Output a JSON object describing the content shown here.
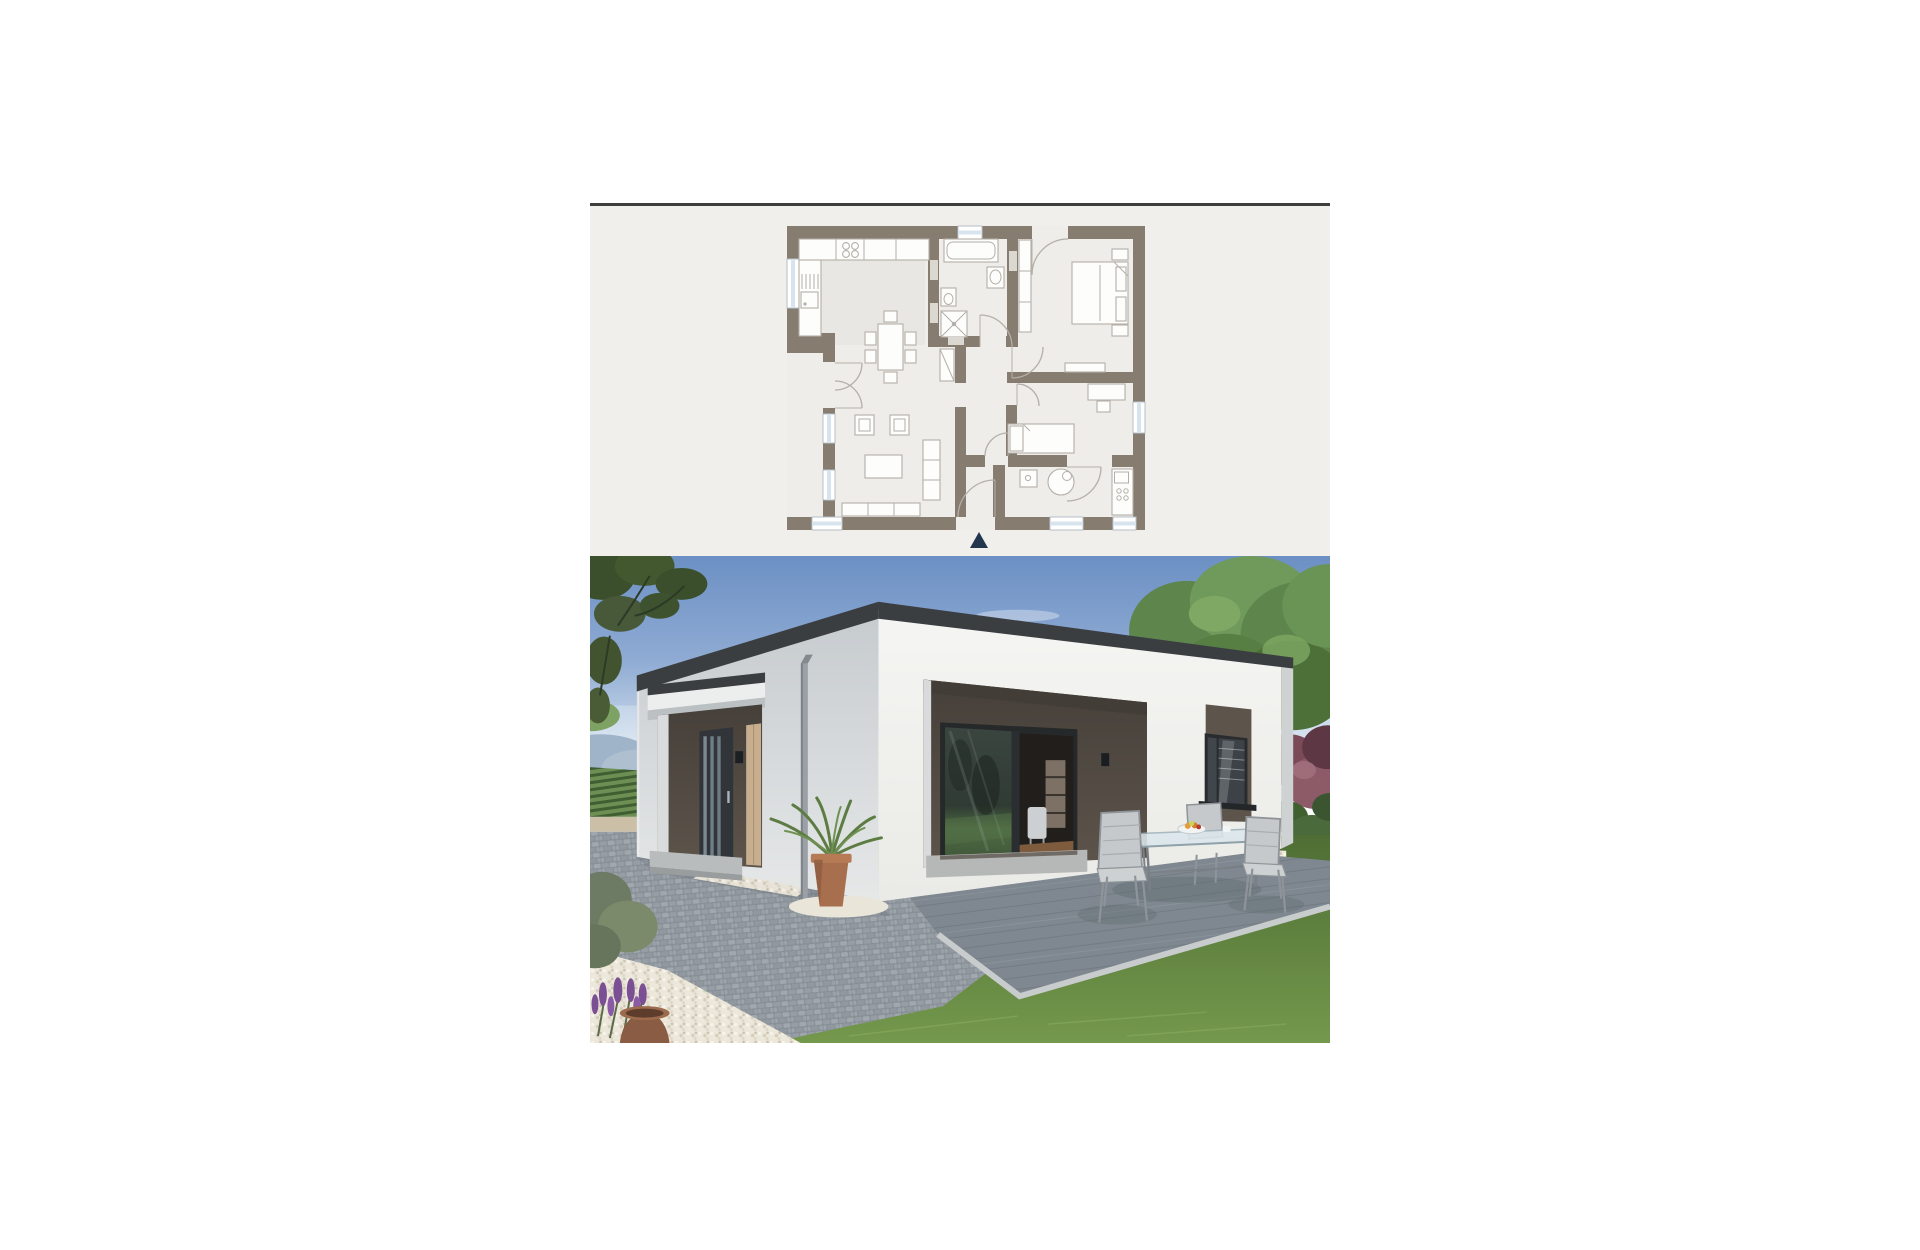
{
  "page": {
    "background": "#ffffff"
  },
  "listing": {
    "description_elements": [
      "floor-plan-panel",
      "exterior-render-photo"
    ],
    "palette": {
      "page-bg": "#ffffff",
      "border-top": "#3e3e3c",
      "panel-bg": "#f1efec",
      "wall": "#867c6f",
      "floor": "#efede9",
      "kitchen-tint": "#e9e7e3",
      "furn-fill": "#fdfdfc",
      "furn-line": "#b4afa8",
      "win-glass": "#d8e4ed",
      "win-frame": "#b5bfc7",
      "wall-tag": "#dbd7d1",
      "north-arrow": "#22364e",
      "sky-top": "#6c90c4",
      "sky-mid": "#8fabd3",
      "sky-horizon": "#e9f0f7",
      "hill": "#9fb4c8",
      "vineyard-dark": "#3f5e31",
      "vineyard-light": "#6d8f54",
      "road": "#cbbfa8",
      "tree-dark": "#3c4f2c",
      "tree-mid": "#5e854c",
      "tree-light": "#7ea863",
      "shrub-purple": "#7a4a58",
      "hedge-green": "#41602f",
      "lawn-dark": "#4e6e35",
      "lawn-light": "#74984c",
      "cobble-base": "#9aa1a7",
      "gravel-white": "#ece7db",
      "deck-gray": "#7f8890",
      "deck-border": "#c8cccd",
      "facade-white": "#f5f5f3",
      "facade-shade": "#c6cbcf",
      "fascia-dark": "#3b3e41",
      "niche-brown": "#5d544b",
      "niche-deep": "#46403a",
      "door-anthracite": "#31353a",
      "panel-tan": "#c6ae8e",
      "terracotta": "#a86f4e",
      "lavender": "#7b4f93",
      "glass-frame": "#26292a",
      "wood-floor": "#7d5b3c",
      "metal-chair": "#8e9499",
      "cushion-gray": "#c6c9cb"
    },
    "floor_plan": {
      "elements": [
        "outer-walls",
        "window-openings",
        "entrance-door-arc",
        "kitchen-counter",
        "hob",
        "sink",
        "dining-table-six-chairs",
        "living-sofa-long",
        "living-sofa-side",
        "armchairs",
        "coffee-table",
        "bathroom-tub",
        "bathroom-basin",
        "bathroom-wc",
        "shower",
        "corridor-wardrobe",
        "bedroom-double-bed",
        "bedroom-wardrobe",
        "nightstands",
        "bench",
        "child-room-single-bed",
        "desk-with-chair",
        "utility-boiler",
        "utility-washer",
        "utility-counter",
        "door-swing-arcs",
        "dimension-tags",
        "north-arrow"
      ]
    },
    "photo": {
      "elements": [
        "sky",
        "clouds",
        "left-tree-silhouette",
        "distant-hills",
        "vineyard-field",
        "country-road",
        "big-right-tree",
        "purple-shrub",
        "green-hedge",
        "lawn",
        "cobblestone-driveway",
        "white-gravel-beds",
        "bungalow-left-facade",
        "entrance-canopy",
        "front-door",
        "door-side-panel",
        "wall-lamp",
        "downpipe",
        "entrance-step",
        "front-facade",
        "roof-fascia",
        "terrace-niche",
        "sliding-glass-doors",
        "interior-shelf",
        "interior-chair",
        "niche-wall-lamp",
        "brown-window-panel",
        "window-with-blinds",
        "window-sill",
        "terrace-wood-deck",
        "deck-border",
        "palm-plant-in-pot",
        "lavender-and-pot",
        "garden-table",
        "fruit-bowl",
        "garden-chairs"
      ]
    }
  }
}
